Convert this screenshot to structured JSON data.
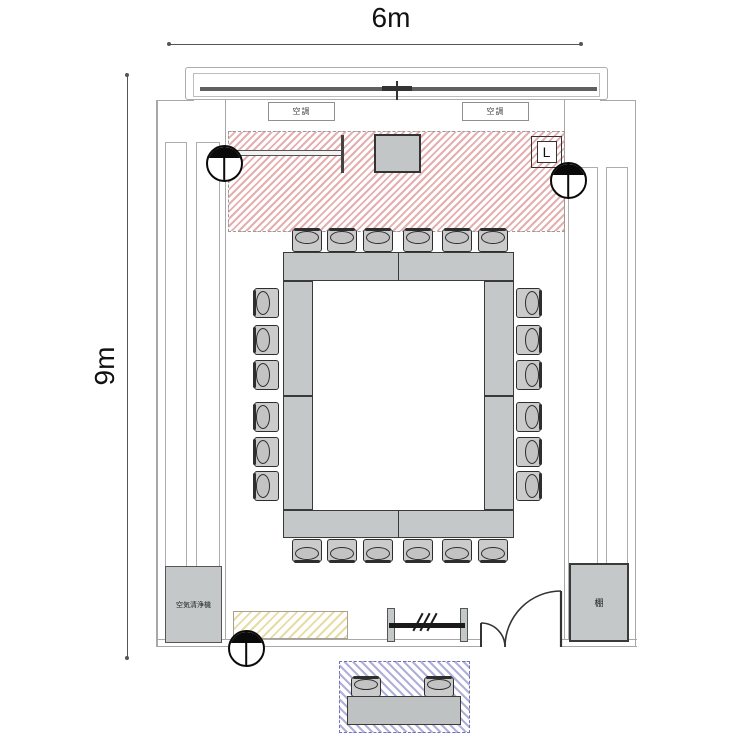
{
  "plan": {
    "name": "meeting-room-floor-plan",
    "width_label": "6m",
    "height_label": "9m"
  },
  "labels": {
    "ac_unit": "空調",
    "air_purifier": "空気清浄機",
    "shelf": "棚",
    "switch": "L"
  },
  "furniture": {
    "chairs": {
      "top": 6,
      "bottom": 6,
      "left": 6,
      "right": 6,
      "reception": 2,
      "total": 26
    },
    "main_table_segments": 8,
    "reception_tables": 1
  },
  "zones": {
    "presentation": {
      "hatch_color": "#cd5f5f",
      "style": "diagonal-stripes",
      "items": [
        "screen",
        "monitor",
        "switch-box"
      ]
    },
    "side_counter": {
      "hatch_color": "#d6be5a",
      "style": "diagonal-stripes"
    },
    "reception": {
      "hatch_color": "#6e6ebe",
      "style": "diagonal-stripes",
      "items": [
        "table",
        "chairs"
      ]
    }
  },
  "colors": {
    "furniture_fill": "#c5c8c8",
    "wall_line": "#a8a8a8",
    "dark_line": "#2e2e2e",
    "background": "#ffffff"
  }
}
